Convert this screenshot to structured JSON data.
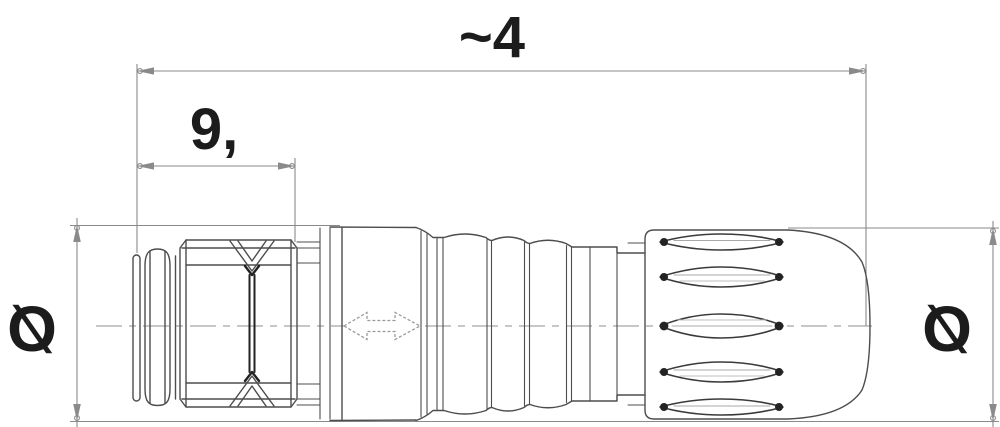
{
  "drawing": {
    "kind": "technical-drawing-connector-side-view",
    "dimensions": {
      "overall_length": "~4",
      "front_length": "9,",
      "diameter_left": "Ø",
      "diameter_right": "Ø"
    },
    "symbols": {
      "mating_direction_arrow": "double-headed-horizontal-arrow",
      "centerline": "dash-dot-center-line"
    },
    "colors": {
      "outline": "#4d4d4d",
      "dark_accent": "#222222",
      "dimension_line": "#8a8a8a",
      "text": "#1c1c1c",
      "background": "#ffffff"
    }
  }
}
